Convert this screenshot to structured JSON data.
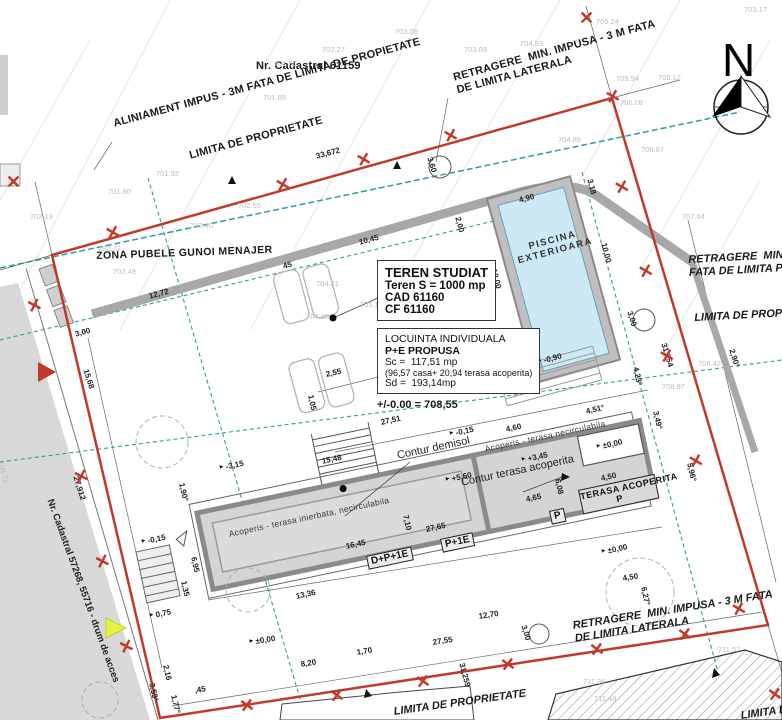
{
  "colors": {
    "boundary": "#c0392b",
    "setback": "#2f9ba3",
    "water": "#cde9f6",
    "wall": "#8a8a8a",
    "roof": "#d4d4d4",
    "road": "#d8d8d8",
    "highlight": "#e3f23f"
  },
  "north_label": "N",
  "title_boxes": {
    "teren": {
      "l1": "TEREN STUDIAT",
      "l2": "Teren S = 1000 mp",
      "l3": "CAD 61160",
      "l4": "CF 61160"
    },
    "locuinta": {
      "l1": "LOCUINTA INDIVIDUALA",
      "l2": "P+E PROPUSA",
      "l3": "Sc =  117,51 mp",
      "l4": "(96,57 casa+ 20,94 terasa acoperita)",
      "l5": "Sd =  193,14mp"
    },
    "level_note": "+/-0.00 = 708,55"
  },
  "labels": [
    {
      "n": "label-cadastral-61159",
      "t": "Nr. Cadastral 61159",
      "x": 256,
      "y": 60,
      "r": 0,
      "c": "lbl"
    },
    {
      "n": "label-retragere-top",
      "t": "RETRAGERE  MIN. IMPUSA - 3 M FATA\nDE LIMITA LATERALA",
      "x": 452,
      "y": 72,
      "r": -15,
      "c": "lbl"
    },
    {
      "n": "label-aliniament",
      "t": "ALINIAMENT IMPUS - 3M FATA DE LIMITA DE PROPIETATE",
      "x": 112,
      "y": 118,
      "r": -15,
      "c": "lbl"
    },
    {
      "n": "label-limita-top",
      "t": "LIMITA DE PROPRIETATE",
      "x": 188,
      "y": 150,
      "r": -15,
      "c": "lbl"
    },
    {
      "n": "label-zona-pubele",
      "t": "ZONA PUBELE GUNOI MENAJER",
      "x": 96,
      "y": 250,
      "r": -2,
      "c": "zona"
    },
    {
      "n": "label-retragere-post",
      "t": "RETRAGERE  MIN. IMPU\nFATA DE LIMITA POSTE",
      "x": 688,
      "y": 254,
      "r": -3,
      "c": "lbl-it"
    },
    {
      "n": "label-limita-right",
      "t": "LIMITA DE PROPRIETA",
      "x": 694,
      "y": 312,
      "r": -3,
      "c": "lbl-it"
    },
    {
      "n": "label-piscina",
      "t": "PISCINA\nEXTERIOARA",
      "x": 514,
      "y": 246,
      "r": -15,
      "c": "pool-lbl"
    },
    {
      "n": "label-contur-demisol",
      "t": "Contur demisol",
      "x": 396,
      "y": 450,
      "r": -12,
      "c": "lbl-reg"
    },
    {
      "n": "label-contur-terasa",
      "t": "Contur terasa acoperita",
      "x": 460,
      "y": 477,
      "r": -12,
      "c": "lbl-reg"
    },
    {
      "n": "label-acoperis-inierbata",
      "t": "Acoperis - terasa inierbata, necirculabila",
      "x": 228,
      "y": 530,
      "r": -12,
      "c": "small-lbl"
    },
    {
      "n": "label-acoperis-necirculabila",
      "t": "Acoperis - terasa necirculabila",
      "x": 484,
      "y": 445,
      "r": -12,
      "c": "small-lbl"
    },
    {
      "n": "label-dp1e",
      "t": "D+P+1E",
      "x": 366,
      "y": 556,
      "r": -12,
      "c": "dimbox"
    },
    {
      "n": "label-p1e",
      "t": "P+1E",
      "x": 440,
      "y": 539,
      "r": -12,
      "c": "dimbox"
    },
    {
      "n": "label-p",
      "t": "P",
      "x": 549,
      "y": 511,
      "r": -12,
      "c": "dimbox"
    },
    {
      "n": "label-terasa-acoperita",
      "t": "TERASA ACOPERITA\nP",
      "x": 578,
      "y": 490,
      "r": -12,
      "c": "dimbox terasa"
    },
    {
      "n": "label-retragere-bottom",
      "t": "RETRAGERE  MIN. IMPUSA - 3 M FATA\nDE LIMITA LATERALA",
      "x": 572,
      "y": 620,
      "r": -9,
      "c": "lbl-it"
    },
    {
      "n": "label-limita-bottom-center",
      "t": "LIMITA DE PROPRIETATE",
      "x": 393,
      "y": 706,
      "r": -8,
      "c": "lbl-it"
    },
    {
      "n": "label-limita-bottom-right",
      "t": "LIMITA DE PROPRIETA",
      "x": 740,
      "y": 710,
      "r": -8,
      "c": "lbl-it"
    },
    {
      "n": "label-drum-acces",
      "t": "Nr. Cadastral 57268, 55716 - drum de acces",
      "x": 54,
      "y": 498,
      "r": 70,
      "c": "road-lbl"
    }
  ],
  "dims": [
    {
      "t": "33,672",
      "x": 315,
      "y": 152,
      "r": -15
    },
    {
      "t": "3,60",
      "x": 434,
      "y": 156,
      "r": 73
    },
    {
      "t": "10,45",
      "x": 358,
      "y": 238,
      "r": -15
    },
    {
      "t": "12,72",
      "x": 148,
      "y": 292,
      "r": -15
    },
    {
      "t": "45",
      "x": 282,
      "y": 262,
      "r": -15
    },
    {
      "t": "3,00",
      "x": 74,
      "y": 330,
      "r": -15
    },
    {
      "t": "15,68",
      "x": 90,
      "y": 368,
      "r": 72
    },
    {
      "t": "27,912",
      "x": 80,
      "y": 475,
      "r": 72
    },
    {
      "t": "2,00",
      "x": 462,
      "y": 216,
      "r": 75
    },
    {
      "t": "4,90",
      "x": 518,
      "y": 196,
      "r": -15
    },
    {
      "t": "10,00",
      "x": 498,
      "y": 268,
      "r": 75
    },
    {
      "t": "10,00",
      "x": 608,
      "y": 242,
      "r": 75
    },
    {
      "t": "3,18",
      "x": 594,
      "y": 178,
      "r": 75
    },
    {
      "t": "-0,90",
      "x": 536,
      "y": 358,
      "r": -15,
      "f": 1
    },
    {
      "t": "3,00",
      "x": 634,
      "y": 310,
      "r": 73
    },
    {
      "t": "31,254",
      "x": 668,
      "y": 342,
      "r": 73
    },
    {
      "t": "2,90°",
      "x": 736,
      "y": 348,
      "r": 73
    },
    {
      "t": "4,23°",
      "x": 640,
      "y": 366,
      "r": 77
    },
    {
      "t": "3,49°",
      "x": 660,
      "y": 410,
      "r": 77
    },
    {
      "t": "5,96°",
      "x": 694,
      "y": 462,
      "r": 77
    },
    {
      "t": "2,55",
      "x": 325,
      "y": 370,
      "r": -12
    },
    {
      "t": "1,05",
      "x": 315,
      "y": 394,
      "r": 78
    },
    {
      "t": "27,51",
      "x": 380,
      "y": 418,
      "r": -12
    },
    {
      "t": "-0,15",
      "x": 448,
      "y": 430,
      "r": -12,
      "f": 1
    },
    {
      "t": "-3,15",
      "x": 218,
      "y": 464,
      "r": -12,
      "f": 1
    },
    {
      "t": "+5,60",
      "x": 444,
      "y": 476,
      "r": -12,
      "f": 1
    },
    {
      "t": "+3,45",
      "x": 520,
      "y": 456,
      "r": -12,
      "f": 1
    },
    {
      "t": "±0,00",
      "x": 595,
      "y": 443,
      "r": -12,
      "f": 1
    },
    {
      "t": "4,60",
      "x": 505,
      "y": 425,
      "r": -12
    },
    {
      "t": "4,51°",
      "x": 585,
      "y": 407,
      "r": -12
    },
    {
      "t": "1,90°",
      "x": 186,
      "y": 482,
      "r": 78
    },
    {
      "t": "15,48",
      "x": 321,
      "y": 457,
      "r": -12
    },
    {
      "t": "16,45",
      "x": 345,
      "y": 542,
      "r": -12
    },
    {
      "t": "13,36",
      "x": 295,
      "y": 592,
      "r": -12
    },
    {
      "t": "27,65",
      "x": 425,
      "y": 525,
      "r": -12
    },
    {
      "t": "7,10",
      "x": 410,
      "y": 514,
      "r": 78
    },
    {
      "t": "6,08",
      "x": 562,
      "y": 478,
      "r": 78
    },
    {
      "t": "4,65",
      "x": 525,
      "y": 495,
      "r": -12
    },
    {
      "t": "4,50",
      "x": 600,
      "y": 474,
      "r": -12
    },
    {
      "t": "1,35",
      "x": 188,
      "y": 580,
      "r": 78
    },
    {
      "t": "6,95",
      "x": 198,
      "y": 556,
      "r": 78
    },
    {
      "t": "±0,00",
      "x": 600,
      "y": 548,
      "r": -12,
      "f": 1
    },
    {
      "t": "±0,00",
      "x": 248,
      "y": 638,
      "r": -9,
      "f": 1
    },
    {
      "t": "-0,15",
      "x": 140,
      "y": 538,
      "r": -12,
      "f": 1
    },
    {
      "t": "0,75",
      "x": 148,
      "y": 612,
      "r": -12,
      "f": 1
    },
    {
      "t": "8,20",
      "x": 300,
      "y": 660,
      "r": -9
    },
    {
      "t": "1,70",
      "x": 356,
      "y": 648,
      "r": -9
    },
    {
      "t": "27,55",
      "x": 432,
      "y": 638,
      "r": -9
    },
    {
      "t": ",45",
      "x": 194,
      "y": 686,
      "r": -9
    },
    {
      "t": "2,16",
      "x": 170,
      "y": 664,
      "r": 77
    },
    {
      "t": "3,53°",
      "x": 156,
      "y": 682,
      "r": 77
    },
    {
      "t": "1,77°",
      "x": 178,
      "y": 694,
      "r": 77
    },
    {
      "t": "12,70",
      "x": 478,
      "y": 612,
      "r": -9
    },
    {
      "t": "3,00",
      "x": 528,
      "y": 624,
      "r": 73
    },
    {
      "t": "31,259",
      "x": 466,
      "y": 662,
      "r": 75
    },
    {
      "t": "6,27°",
      "x": 648,
      "y": 586,
      "r": 78
    },
    {
      "t": "4,50",
      "x": 622,
      "y": 574,
      "r": -9
    }
  ],
  "elevations": [
    {
      "t": "702.27",
      "x": 322,
      "y": 46
    },
    {
      "t": "701.56",
      "x": 274,
      "y": 60
    },
    {
      "t": "701.89",
      "x": 263,
      "y": 94
    },
    {
      "t": "703.08",
      "x": 395,
      "y": 28
    },
    {
      "t": "703.69",
      "x": 464,
      "y": 46
    },
    {
      "t": "704.93",
      "x": 520,
      "y": 40
    },
    {
      "t": "705.24",
      "x": 596,
      "y": 18
    },
    {
      "t": "703.17",
      "x": 744,
      "y": 6
    },
    {
      "t": "705.94",
      "x": 616,
      "y": 75
    },
    {
      "t": "705.12",
      "x": 658,
      "y": 74
    },
    {
      "t": "706.08",
      "x": 620,
      "y": 99
    },
    {
      "t": "706.87",
      "x": 641,
      "y": 146
    },
    {
      "t": "707.64",
      "x": 682,
      "y": 213
    },
    {
      "t": "708.42",
      "x": 698,
      "y": 360
    },
    {
      "t": "708.97",
      "x": 662,
      "y": 383
    },
    {
      "t": "701.92",
      "x": 156,
      "y": 170
    },
    {
      "t": "701.80",
      "x": 108,
      "y": 188
    },
    {
      "t": "702.19",
      "x": 30,
      "y": 213
    },
    {
      "t": "702.72",
      "x": 98,
      "y": 245
    },
    {
      "t": "702.49",
      "x": 113,
      "y": 268
    },
    {
      "t": "702.40",
      "x": 190,
      "y": 222
    },
    {
      "t": "702.55",
      "x": 238,
      "y": 202
    },
    {
      "t": "704.21",
      "x": 316,
      "y": 280
    },
    {
      "t": "704.98",
      "x": 306,
      "y": 313
    },
    {
      "t": "705.18",
      "x": 360,
      "y": 301
    },
    {
      "t": "704.89",
      "x": 558,
      "y": 136
    },
    {
      "t": "711.57",
      "x": 718,
      "y": 646
    },
    {
      "t": "711.36",
      "x": 583,
      "y": 678
    },
    {
      "t": "711.48",
      "x": 594,
      "y": 695
    },
    {
      "t": "708.72",
      "x": 4,
      "y": 460,
      "r": 75
    }
  ],
  "x_marks": [
    {
      "x": 112,
      "y": 236,
      "r": -15
    },
    {
      "x": 282,
      "y": 188,
      "r": -15
    },
    {
      "x": 363,
      "y": 163,
      "r": -15
    },
    {
      "x": 450,
      "y": 139,
      "r": -15
    },
    {
      "x": 612,
      "y": 100,
      "r": -15
    },
    {
      "x": 588,
      "y": 19,
      "r": 0
    },
    {
      "x": 15,
      "y": 183,
      "r": 0
    },
    {
      "x": 638,
      "y": 188,
      "r": 75
    },
    {
      "x": 662,
      "y": 272,
      "r": 75
    },
    {
      "x": 683,
      "y": 357,
      "r": 75
    },
    {
      "x": 712,
      "y": 462,
      "r": 75
    },
    {
      "x": 755,
      "y": 610,
      "r": 75
    },
    {
      "x": 247,
      "y": 708,
      "r": -9
    },
    {
      "x": 337,
      "y": 698,
      "r": -9
    },
    {
      "x": 423,
      "y": 684,
      "r": -9
    },
    {
      "x": 508,
      "y": 667,
      "r": -9
    },
    {
      "x": 597,
      "y": 652,
      "r": -9
    },
    {
      "x": 685,
      "y": 637,
      "r": -9
    },
    {
      "x": 775,
      "y": 697,
      "r": -9
    },
    {
      "x": 50,
      "y": 306,
      "r": 72
    },
    {
      "x": 97,
      "y": 477,
      "r": 72
    },
    {
      "x": 118,
      "y": 562,
      "r": 72
    },
    {
      "x": 142,
      "y": 647,
      "r": 72
    }
  ]
}
